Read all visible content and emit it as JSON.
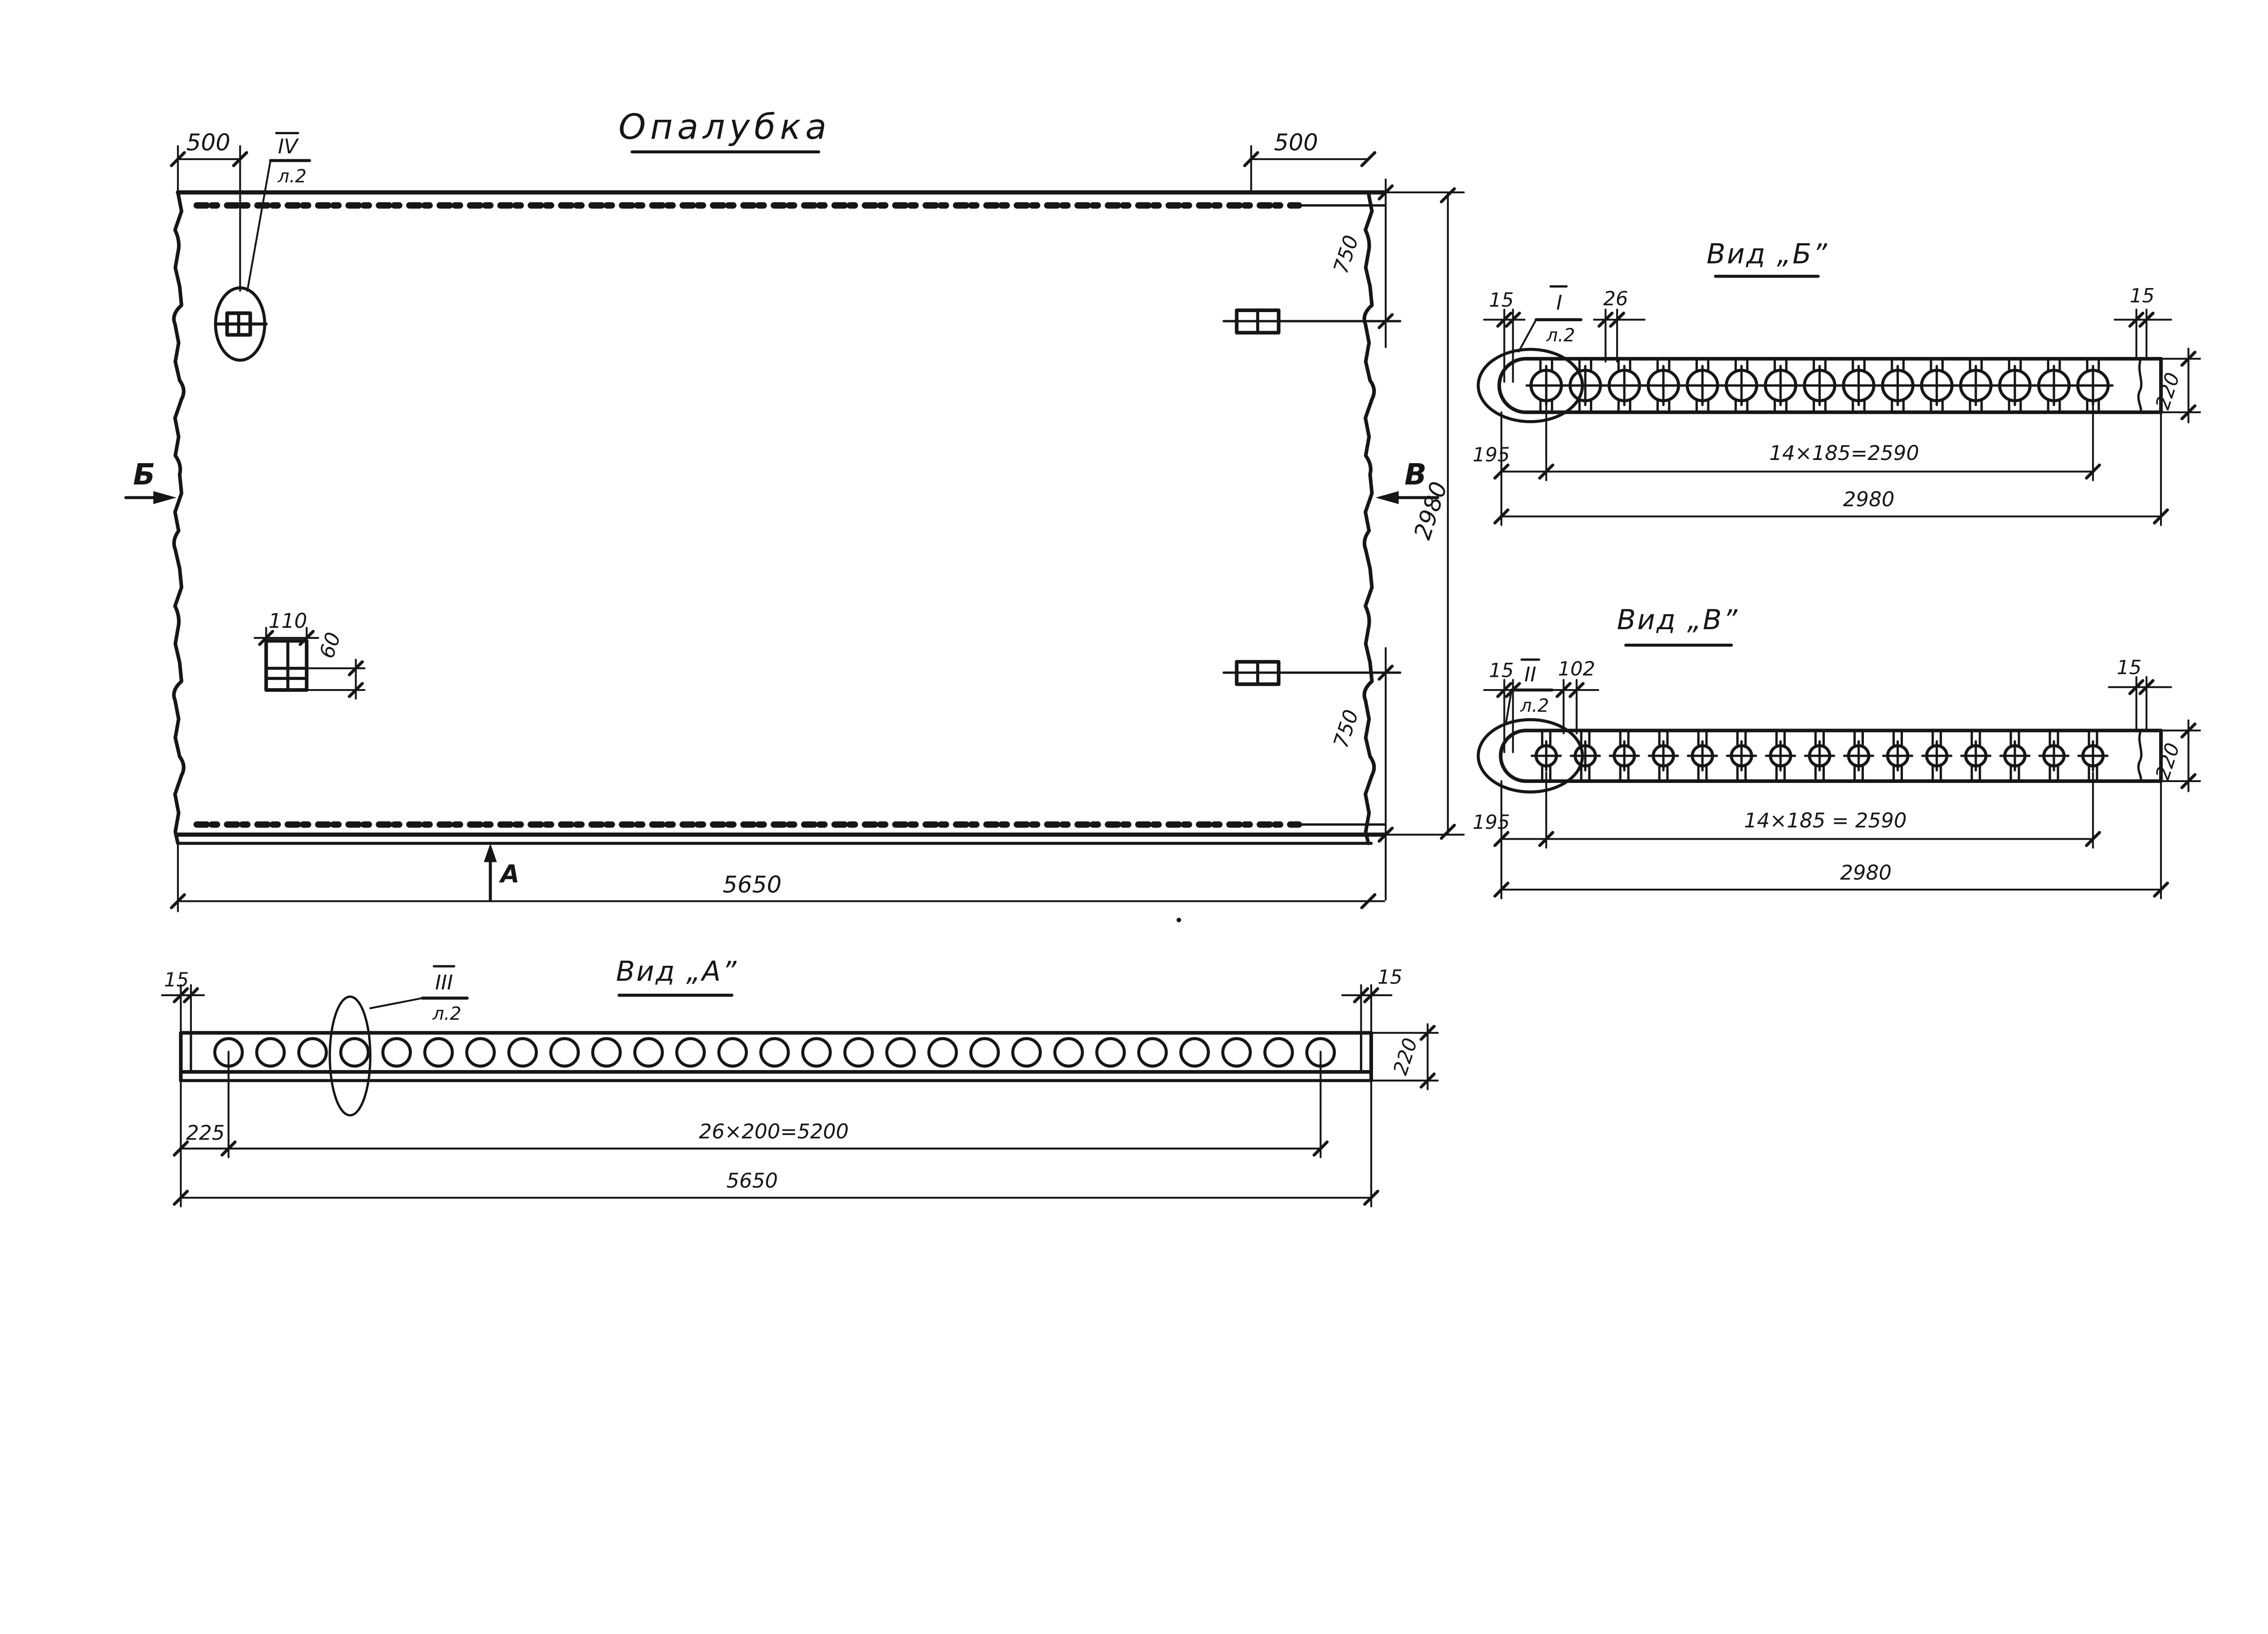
{
  "plan": {
    "title": "Опалубка",
    "callout_ref": "IV",
    "callout_sheet": "л.2",
    "marker_left": "Б",
    "marker_right": "В",
    "marker_bottom": "А",
    "dim_500_left": "500",
    "dim_500_right": "500",
    "dim_750_top": "750",
    "dim_750_bottom": "750",
    "dim_2980": "2980",
    "dim_5650": "5650",
    "dim_110": "110",
    "dim_60": "60"
  },
  "view_a": {
    "title": "Вид „А”",
    "callout_ref": "III",
    "callout_sheet": "л.2",
    "dim_15_left": "15",
    "dim_15_right": "15",
    "dim_225": "225",
    "dim_holes": "26×200=5200",
    "dim_5650": "5650",
    "dim_220": "220",
    "holes_count": 27
  },
  "view_b": {
    "title": "Вид „Б”",
    "callout_ref": "I",
    "callout_sheet": "л.2",
    "dim_15_left": "15",
    "dim_26": "26",
    "dim_15_right": "15",
    "dim_195": "195",
    "dim_bolts": "14×185=2590",
    "dim_2980": "2980",
    "dim_220": "220",
    "bolts_count": 15
  },
  "view_v": {
    "title": "Вид „В”",
    "callout_ref": "II",
    "callout_sheet": "л.2",
    "dim_15_left": "15",
    "dim_102": "102",
    "dim_15_right": "15",
    "dim_195": "195",
    "dim_bolts": "14×185 = 2590",
    "dim_2980": "2980",
    "dim_220": "220",
    "bolts_count": 15
  },
  "colors": {
    "ink": "#161616",
    "paper": "#ffffff"
  }
}
